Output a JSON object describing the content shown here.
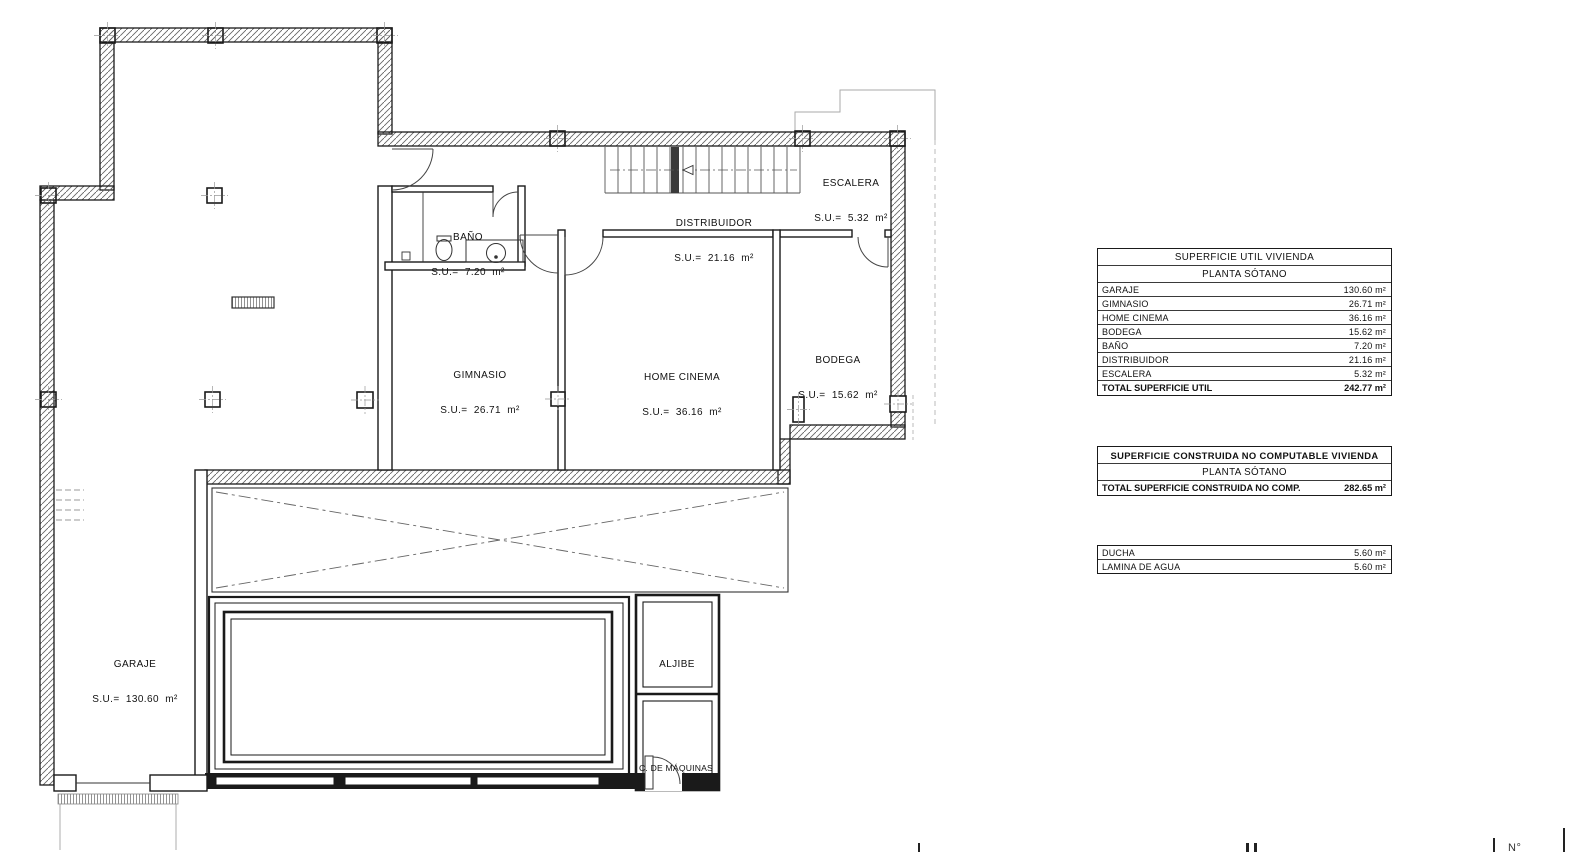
{
  "plan": {
    "rooms": [
      {
        "label": "GARAJE",
        "su": "S.U.=  130.60  m²"
      },
      {
        "label": "GIMNASIO",
        "su": "S.U.=  26.71  m²"
      },
      {
        "label": "HOME CINEMA",
        "su": "S.U.=  36.16  m²"
      },
      {
        "label": "BODEGA",
        "su": "S.U.=  15.62  m²"
      },
      {
        "label": "BAÑO",
        "su": "S.U.=  7.20  m²"
      },
      {
        "label": "DISTRIBUIDOR",
        "su": "S.U.=  21.16  m²"
      },
      {
        "label": "ESCALERA",
        "su": "S.U.=  5.32  m²"
      },
      {
        "label": "ALJIBE"
      },
      {
        "label": "C. DE MÁQUINAS"
      }
    ]
  },
  "tables": {
    "util": {
      "title": "SUPERFICIE UTIL VIVIENDA",
      "subtitle": "PLANTA SÓTANO",
      "rows": [
        [
          "GARAJE",
          "130.60 m²"
        ],
        [
          "GIMNASIO",
          "26.71 m²"
        ],
        [
          "HOME CINEMA",
          "36.16 m²"
        ],
        [
          "BODEGA",
          "15.62 m²"
        ],
        [
          "BAÑO",
          "7.20 m²"
        ],
        [
          "DISTRIBUIDOR",
          "21.16 m²"
        ],
        [
          "ESCALERA",
          "5.32 m²"
        ]
      ],
      "total_label": "TOTAL SUPERFICIE UTIL",
      "total_value": "242.77 m²"
    },
    "construida": {
      "title": "SUPERFICIE CONSTRUIDA NO COMPUTABLE VIVIENDA",
      "subtitle": "PLANTA SÓTANO",
      "total_label": "TOTAL SUPERFICIE CONSTRUIDA NO COMP.",
      "total_value": "282.65 m²"
    },
    "extras": {
      "rows": [
        [
          "DUCHA",
          "5.60 m²"
        ],
        [
          "LAMINA DE AGUA",
          "5.60 m²"
        ]
      ]
    }
  },
  "footer": {
    "sheet_label": "N°"
  }
}
